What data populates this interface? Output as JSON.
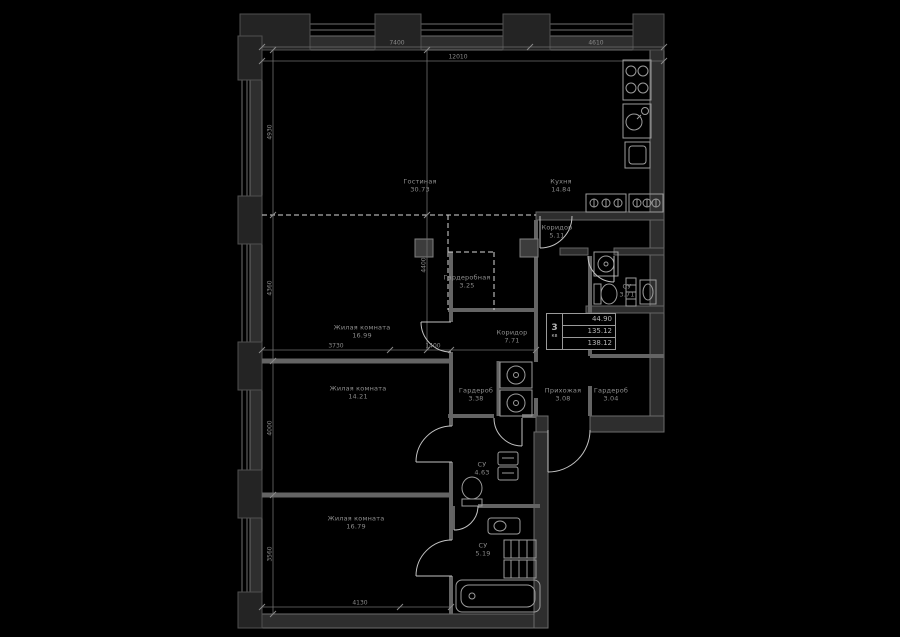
{
  "plan": {
    "badge": {
      "number": "3",
      "label": "кв"
    },
    "stats": {
      "row1": "44.90",
      "row2": "135.12",
      "row3": "138.12"
    },
    "rooms": [
      {
        "name": "Гостиная",
        "area": "30.73"
      },
      {
        "name": "Кухня",
        "area": "14.84"
      },
      {
        "name": "Коридор",
        "area": "5.11"
      },
      {
        "name": "Гардеробная",
        "area": "3.25"
      },
      {
        "name": "СУ",
        "area": "3.71"
      },
      {
        "name": "Жилая комната",
        "area": "16.99"
      },
      {
        "name": "Коридор",
        "area": "7.71"
      },
      {
        "name": "Гардероб",
        "area": "3.38"
      },
      {
        "name": "Прихожая",
        "area": "3.08"
      },
      {
        "name": "Гардероб",
        "area": "3.04"
      },
      {
        "name": "Жилая комната",
        "area": "14.21"
      },
      {
        "name": "СУ",
        "area": "4.63"
      },
      {
        "name": "Жилая комната",
        "area": "16.79"
      },
      {
        "name": "СУ",
        "area": "5.19"
      }
    ],
    "dimensions": {
      "top_left": "7400",
      "top_right": "4610",
      "top_total": "12010",
      "left_top": "4930",
      "left_upper_mid": "4360",
      "left_lower_mid": "4000",
      "left_bottom": "3560",
      "center_vertical": "4400",
      "middle_left": "3730",
      "middle_center": "1400",
      "bottom": "4130"
    },
    "colors": {
      "background": "#000000",
      "wall_fill": "#2e2e2e",
      "wall_edge": "#6b6b6b",
      "fixture_line": "#9c9c9c",
      "door_arc": "#c2c2c2",
      "text": "#8f8f8f"
    }
  }
}
